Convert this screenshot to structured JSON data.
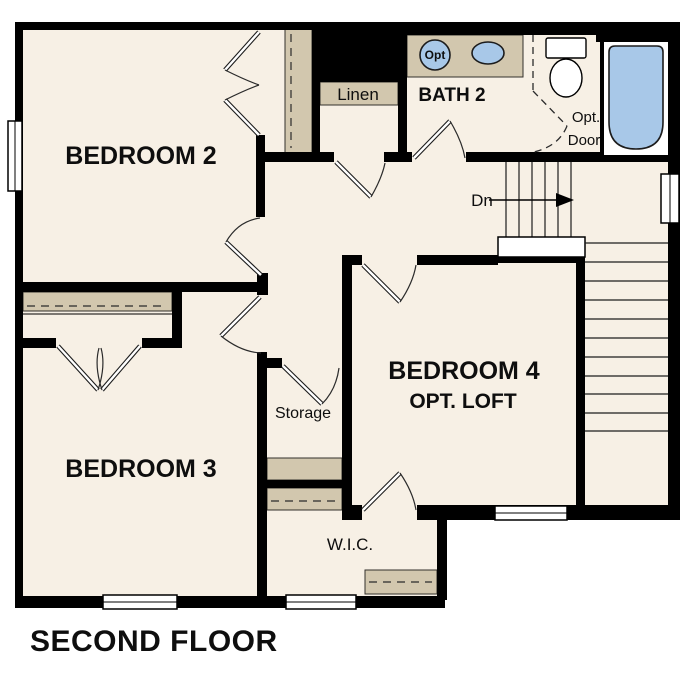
{
  "title": "SECOND FLOOR",
  "colors": {
    "floor": "#f7f0e5",
    "shelf": "#d2c7ae",
    "fixture_blue": "#a8c8e8",
    "wall": "#000000",
    "background": "#ffffff"
  },
  "rooms": {
    "bedroom2": "BEDROOM 2",
    "bedroom3": "BEDROOM 3",
    "bedroom4": "BEDROOM 4",
    "bedroom4_sub": "OPT. LOFT",
    "bath2": "BATH 2",
    "linen": "Linen",
    "storage": "Storage",
    "wic": "W.I.C."
  },
  "stairs": {
    "direction_label": "Dn"
  },
  "annotations": {
    "opt_door_line1": "Opt.",
    "opt_door_line2": "Door",
    "opt_sink": "Opt"
  }
}
